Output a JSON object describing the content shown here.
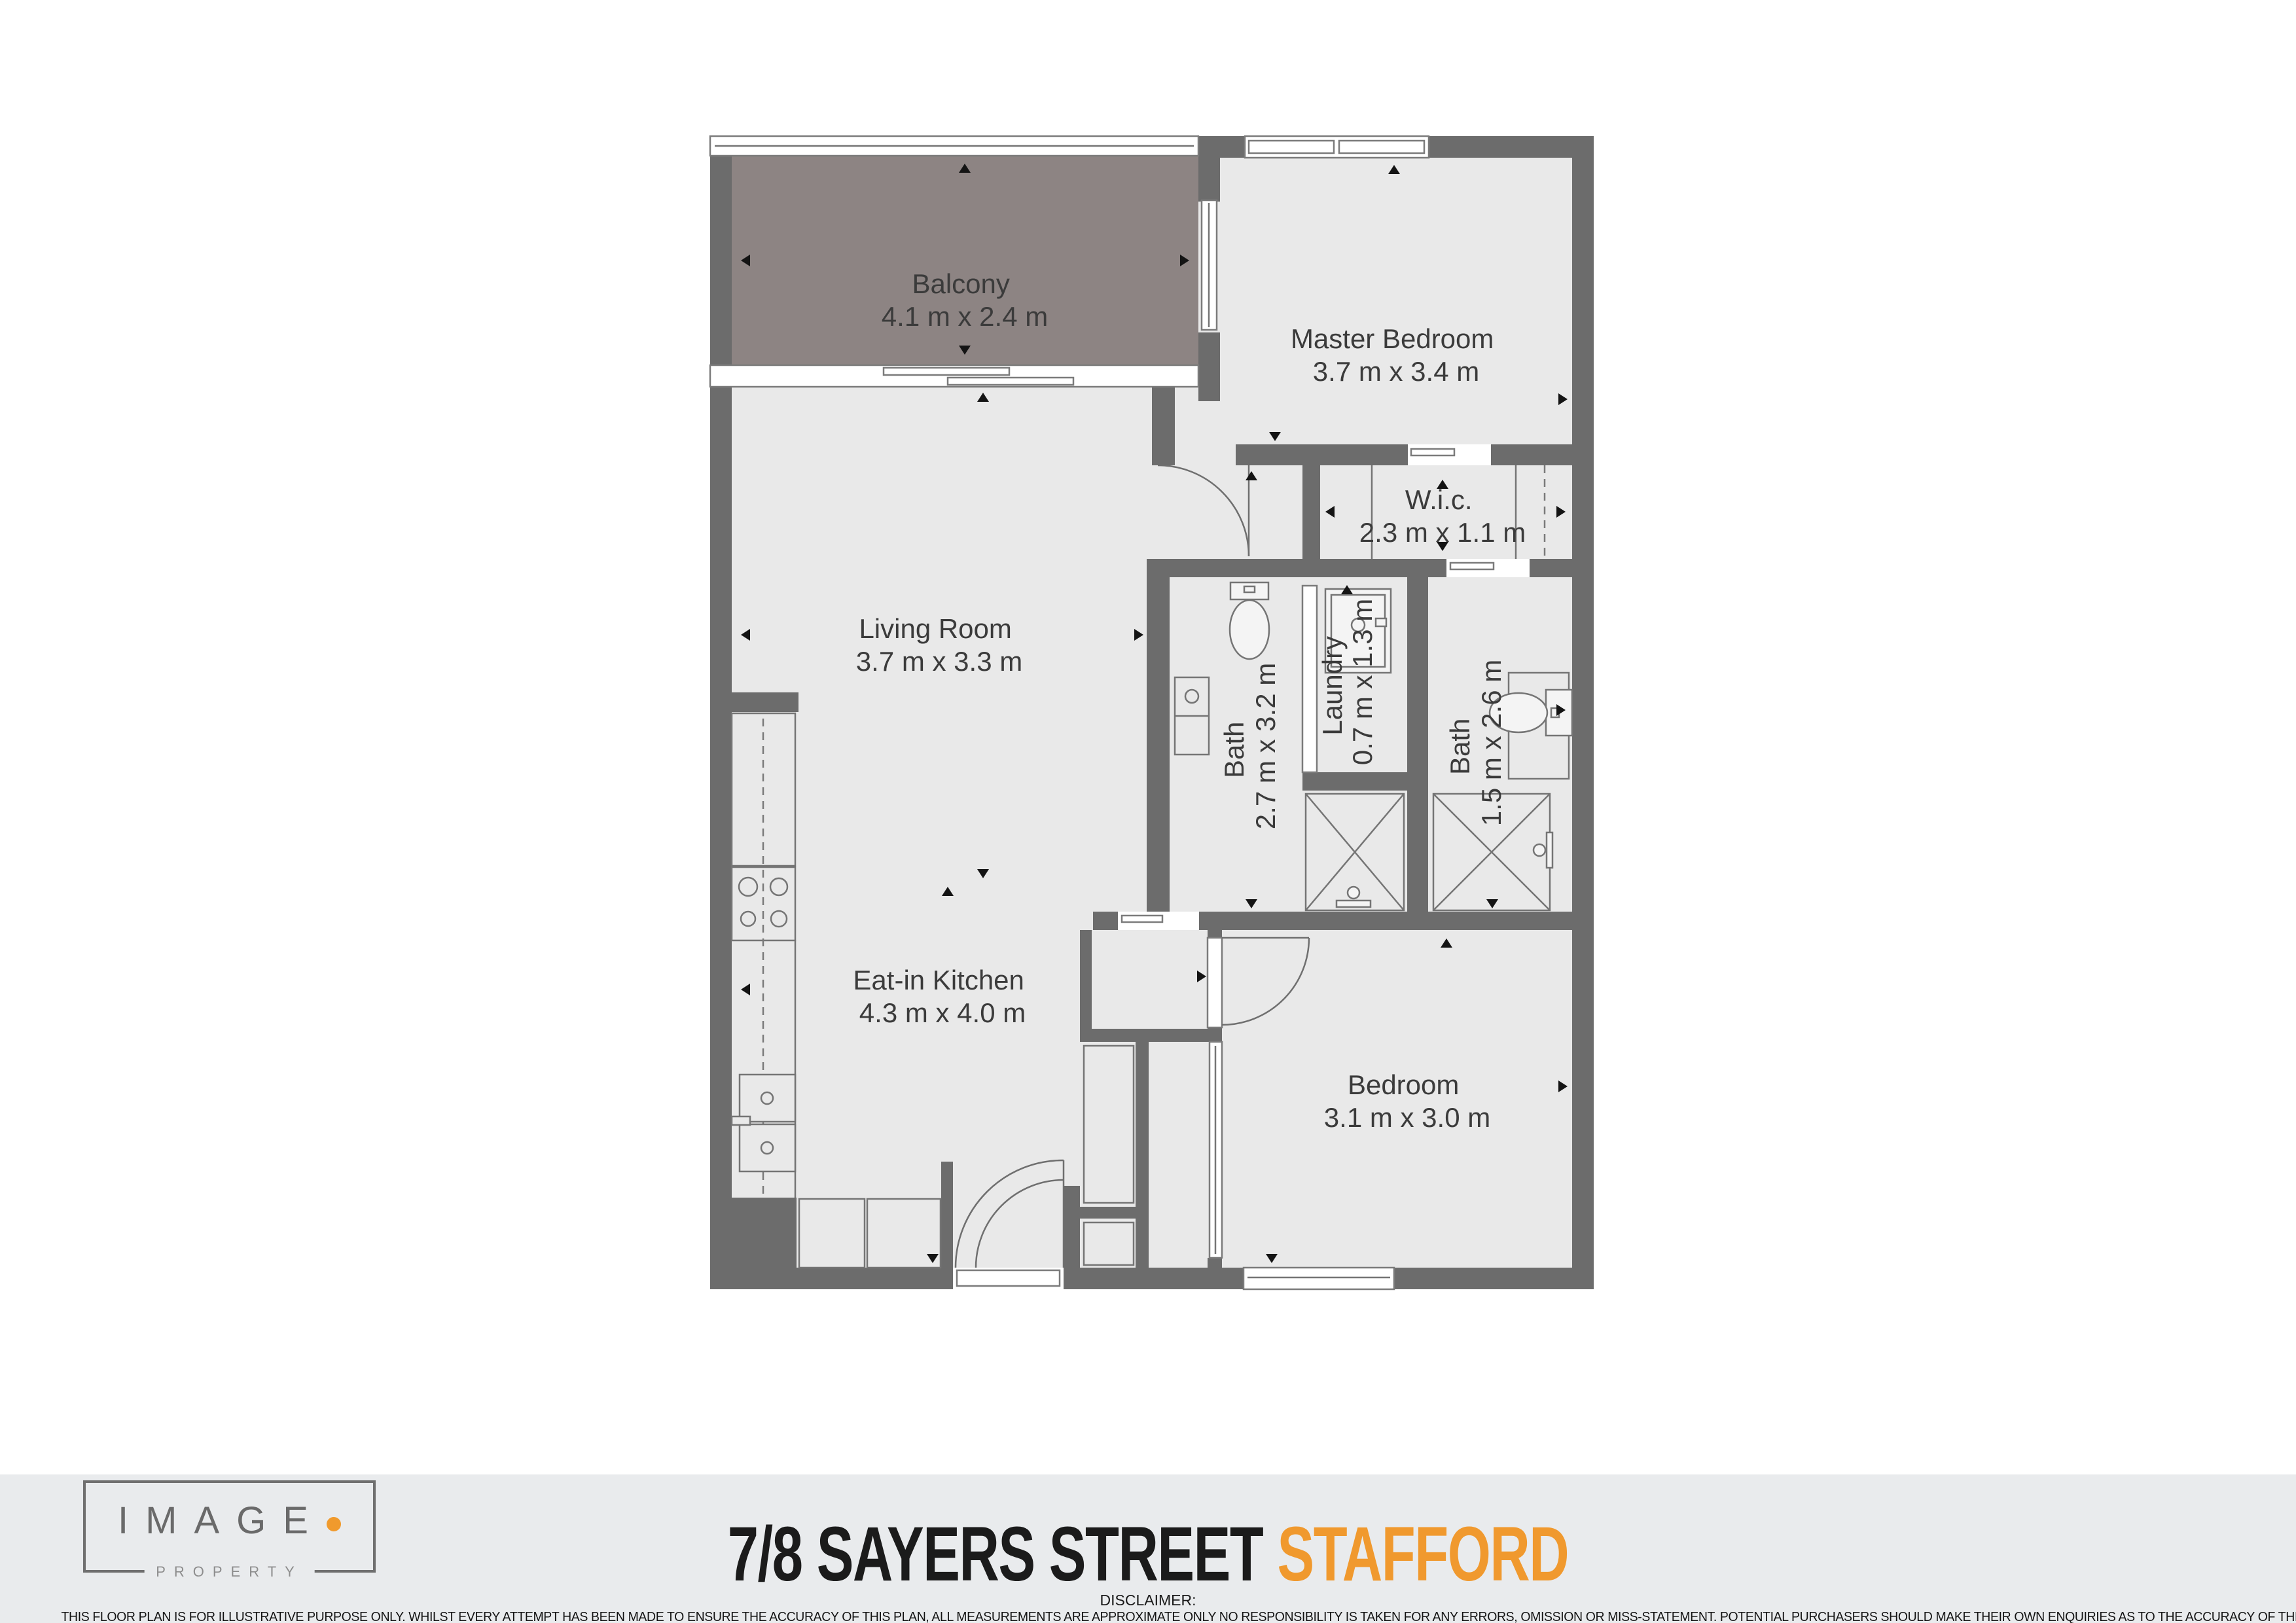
{
  "plan": {
    "rooms": [
      {
        "name": "Balcony",
        "dims": "4.1 m x 2.4 m"
      },
      {
        "name": "Master Bedroom",
        "dims": "3.7 m x 3.4 m"
      },
      {
        "name": "W.i.c.",
        "dims": "2.3 m x 1.1 m"
      },
      {
        "name": "Living Room",
        "dims": "3.7 m x 3.3 m"
      },
      {
        "name": "Bath",
        "dims": "2.7 m x 3.2 m"
      },
      {
        "name": "Laundry",
        "dims": "0.7 m x 1.3 m"
      },
      {
        "name": "Bath",
        "dims": "1.5 m x 2.6 m"
      },
      {
        "name": "Eat-in Kitchen",
        "dims": "4.3 m x 4.0 m"
      },
      {
        "name": "Bedroom",
        "dims": "3.1 m x 3.0 m"
      }
    ],
    "colors": {
      "wall": "#6c6c6c",
      "floor": "#e9e9e9",
      "balcony_floor": "#8d8483",
      "accent_orange": "#f0992e",
      "footer_band": "#e9ebed"
    }
  },
  "footer": {
    "logo": {
      "brand": "IMAGE",
      "sub": "PROPERTY"
    },
    "address": "7/8 SAYERS STREET ",
    "suburb": "STAFFORD",
    "disclaimer_label": "DISCLAIMER:",
    "disclaimer": "THIS FLOOR PLAN IS FOR ILLUSTRATIVE PURPOSE ONLY. WHILST EVERY ATTEMPT HAS BEEN MADE TO ENSURE THE ACCURACY OF THIS PLAN, ALL MEASUREMENTS ARE APPROXIMATE ONLY NO RESPONSIBILITY IS TAKEN FOR ANY ERRORS, OMISSION OR MISS-STATEMENT. POTENTIAL PURCHASERS SHOULD MAKE THEIR OWN ENQUIRIES AS TO THE ACCURACY OF THIS FLOOR PLAN"
  }
}
